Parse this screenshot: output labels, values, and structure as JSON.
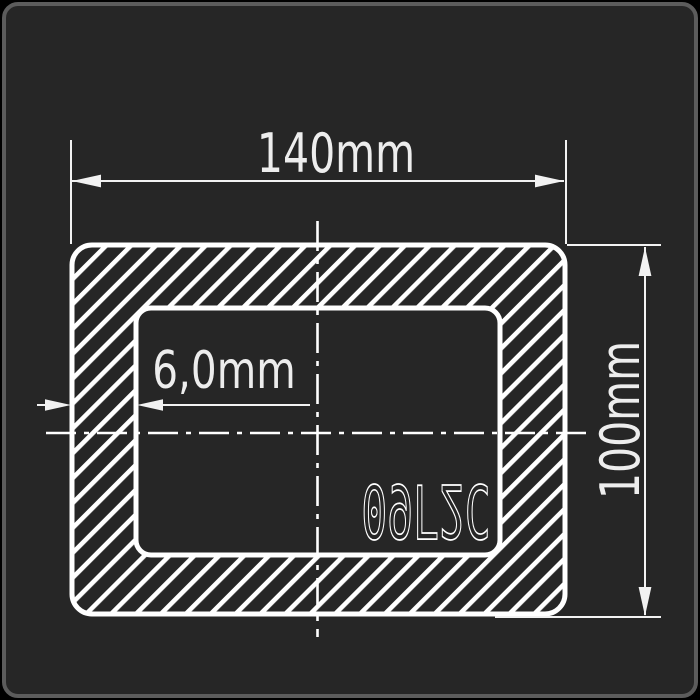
{
  "canvas": {
    "outside_color": "#000000",
    "panel_background": "#262626",
    "panel_border_color": "#5c5c5c",
    "line_color": "#ffffff",
    "label_color": "#ededed"
  },
  "drawing": {
    "subject": "rectangular-steel-tube-cross-section",
    "labels": {
      "width": "140mm",
      "height": "100mm",
      "wall_thickness": "6,0mm",
      "steel_grade": "09Г2С"
    }
  }
}
